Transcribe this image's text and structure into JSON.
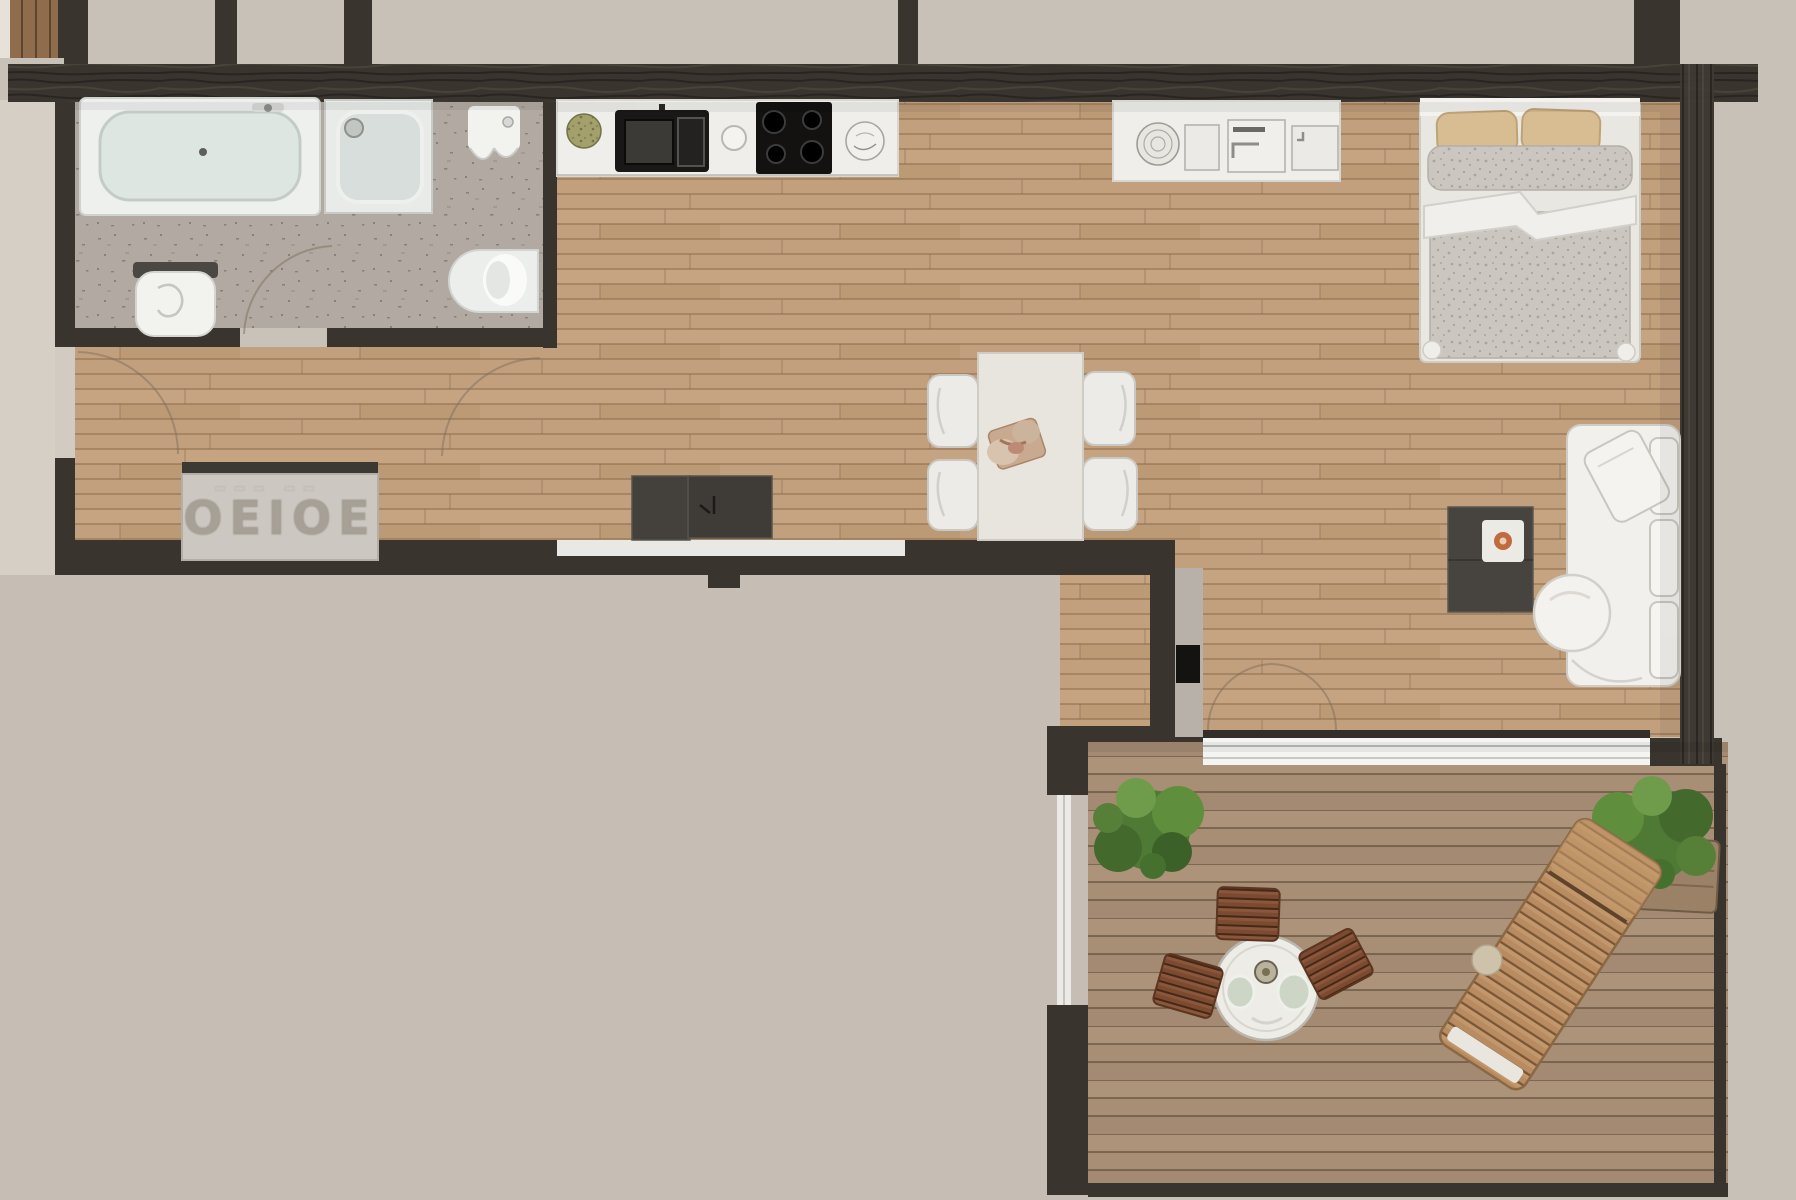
{
  "meta": {
    "title": "apartment-floor-plan-top-down-render",
    "view": "top-down architectural render",
    "style": "photorealistic 3D floor plan"
  },
  "palette": {
    "exterior": "#c8c1b8",
    "exterior_ground": "#c6beb4",
    "wall_dark": "#3a342e",
    "wall_face_light": "#b7b1a9",
    "wood_floor": "#c2a07e",
    "wood_gap": "#8a694a",
    "deck_wood": "#a88e75",
    "deck_gap": "#604d3a",
    "tile_floor": "#b2aaa2",
    "counter_white": "#efeeea",
    "fixture_white": "#f2f2ef",
    "water_green": "#dde6e1",
    "cabinet_dark": "#44413d",
    "media_table_dark": "#474440",
    "sofa_white": "#f1f0ec",
    "duvet_gray": "#cbc7c0",
    "pillow_tan": "#d9bd92",
    "plant_green": "#4e7a35",
    "bistro_chair_brown": "#7c4a30",
    "lounger_wood": "#b88c60",
    "glass_white": "#f4f4f2",
    "railing_white": "#eceae6",
    "accent_orange": "#c06a3e",
    "console_gray": "#ccc8c1",
    "embossed_letter_gray": "#a09a8f",
    "appliance_black": "#1a1816"
  },
  "rooms": {
    "bathroom": {
      "label": "bathroom",
      "floor": "speckled gray tile",
      "fixtures": [
        "bathtub",
        "shower",
        "wall-hung-basin",
        "toilet",
        "wall-toilet"
      ]
    },
    "hallway": {
      "label": "entry hallway",
      "floor": "oak plank",
      "console_text": "OEIOE",
      "furniture": [
        "console-sideboard-with-embossed-text",
        "entry-door-swing"
      ]
    },
    "kitchen": {
      "label": "kitchen",
      "fixtures": [
        "wall-counter",
        "plant-bowl",
        "microwave",
        "cooktop-4-burner",
        "sink",
        "island-counter",
        "island-sink",
        "storage-modules"
      ]
    },
    "dining": {
      "label": "dining area",
      "furniture": [
        "rectangular-table",
        "chair x4",
        "centerpiece-platter"
      ]
    },
    "living": {
      "label": "living area",
      "furniture": [
        "white-sofa",
        "round-ottoman",
        "dark-media-table",
        "white-tray",
        "orange-bowl",
        "dark-sideboard-cabinet"
      ]
    },
    "sleeping": {
      "label": "sleeping area",
      "furniture": [
        "double-bed",
        "pillow x2",
        "gray-duvet",
        "white-sheet-fold"
      ]
    },
    "balcony": {
      "label": "balcony / terrace",
      "floor": "composite deck planks",
      "furniture": [
        "round-bistro-table",
        "glass-cup x2",
        "slatted-chair x3",
        "wooden-sun-lounger",
        "green-plant x2",
        "glass-railing",
        "sliding-glass-door"
      ]
    }
  }
}
